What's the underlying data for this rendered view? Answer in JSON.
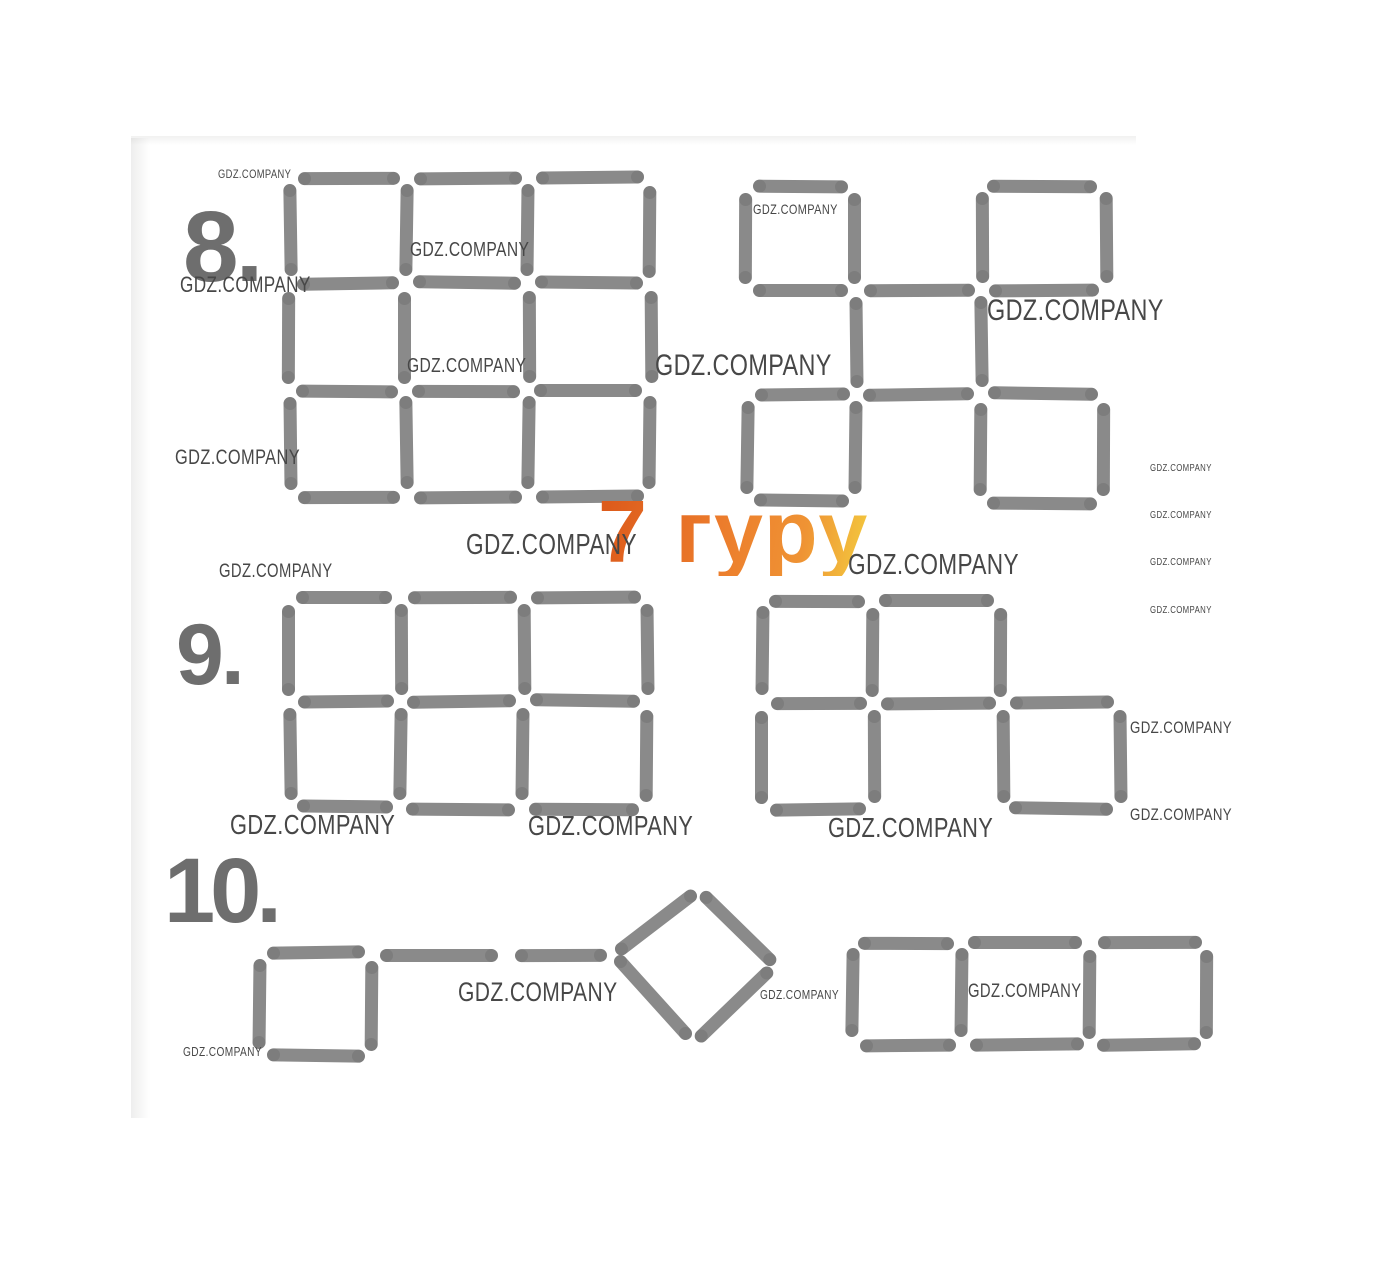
{
  "page": {
    "width": 1376,
    "height": 1261,
    "background": "#ffffff"
  },
  "colors": {
    "stick": "#8a8a8a",
    "stick_cap": "#6f6f6f",
    "label": "#6e6e6e",
    "watermark": "#474747",
    "logo_orange": [
      "#dd5c1c",
      "#ec7c2c",
      "#f3c83e"
    ]
  },
  "puzzles": [
    {
      "number": "8."
    },
    {
      "number": "9."
    },
    {
      "number": "10."
    }
  ],
  "logo": {
    "text": "7 гуру"
  },
  "watermark_text": "GDZ.COMPANY",
  "watermarks": [
    {
      "x": 218,
      "y": 171,
      "s": 12
    },
    {
      "x": 180,
      "y": 279,
      "s": 22
    },
    {
      "x": 410,
      "y": 244,
      "s": 20
    },
    {
      "x": 407,
      "y": 360,
      "s": 20
    },
    {
      "x": 175,
      "y": 452,
      "s": 21
    },
    {
      "x": 655,
      "y": 358,
      "s": 30
    },
    {
      "x": 753,
      "y": 205,
      "s": 14
    },
    {
      "x": 987,
      "y": 303,
      "s": 30
    },
    {
      "x": 1150,
      "y": 466,
      "s": 10
    },
    {
      "x": 1150,
      "y": 513,
      "s": 10
    },
    {
      "x": 1150,
      "y": 560,
      "s": 10
    },
    {
      "x": 1150,
      "y": 608,
      "s": 10
    },
    {
      "x": 466,
      "y": 537,
      "s": 29
    },
    {
      "x": 848,
      "y": 557,
      "s": 29
    },
    {
      "x": 219,
      "y": 566,
      "s": 19
    },
    {
      "x": 230,
      "y": 817,
      "s": 28
    },
    {
      "x": 528,
      "y": 818,
      "s": 28
    },
    {
      "x": 828,
      "y": 820,
      "s": 28
    },
    {
      "x": 1130,
      "y": 723,
      "s": 17
    },
    {
      "x": 1130,
      "y": 810,
      "s": 17
    },
    {
      "x": 458,
      "y": 985,
      "s": 27
    },
    {
      "x": 760,
      "y": 991,
      "s": 13
    },
    {
      "x": 968,
      "y": 986,
      "s": 19
    },
    {
      "x": 183,
      "y": 1048,
      "s": 13
    }
  ],
  "figures": {
    "grids": [
      {
        "name": "puzzle8-left-grid",
        "xs": [
          290,
          406,
          528,
          650
        ],
        "ys": [
          178,
          284,
          390,
          497
        ],
        "h": [
          [
            1,
            1,
            1
          ],
          [
            1,
            1,
            1
          ],
          [
            1,
            1,
            1
          ],
          [
            1,
            1,
            1
          ]
        ],
        "v": [
          [
            1,
            1,
            1,
            1
          ],
          [
            1,
            1,
            1,
            1
          ],
          [
            1,
            1,
            1,
            1
          ]
        ]
      },
      {
        "name": "puzzle8-right-grid",
        "xs": [
          747,
          856,
          981,
          1105
        ],
        "ys": [
          185,
          290,
          395,
          502
        ],
        "h": [
          [
            1,
            0,
            1
          ],
          [
            1,
            1,
            1
          ],
          [
            1,
            1,
            1
          ],
          [
            1,
            0,
            1
          ]
        ],
        "v": [
          [
            1,
            1,
            1,
            1
          ],
          [
            0,
            1,
            1,
            0
          ],
          [
            1,
            1,
            1,
            1
          ]
        ]
      },
      {
        "name": "puzzle9-left-grid",
        "xs": [
          290,
          400,
          523,
          647
        ],
        "ys": [
          597,
          702,
          808
        ],
        "h": [
          [
            1,
            1,
            1
          ],
          [
            1,
            1,
            1
          ],
          [
            1,
            1,
            1
          ]
        ],
        "v": [
          [
            1,
            1,
            1,
            1
          ],
          [
            1,
            1,
            1,
            1
          ]
        ]
      },
      {
        "name": "puzzle9-right-grid",
        "xs": [
          763,
          873,
          1002,
          1120
        ],
        "ys": [
          600,
          703,
          810
        ],
        "h": [
          [
            1,
            1,
            0
          ],
          [
            1,
            1,
            1
          ],
          [
            1,
            0,
            1
          ]
        ],
        "v": [
          [
            1,
            1,
            1,
            0
          ],
          [
            1,
            1,
            1,
            1
          ]
        ]
      },
      {
        "name": "puzzle10-square",
        "xs": [
          260,
          372
        ],
        "ys": [
          953,
          1057
        ],
        "h": [
          [
            1
          ],
          [
            1
          ]
        ],
        "v": [
          [
            1,
            1
          ]
        ]
      },
      {
        "name": "puzzle10-row-of-squares",
        "xs": [
          852,
          962,
          1090,
          1208
        ],
        "ys": [
          942,
          1045
        ],
        "h": [
          [
            1,
            1,
            1
          ],
          [
            1,
            1,
            1
          ]
        ],
        "v": [
          [
            1,
            1,
            1,
            1
          ]
        ]
      }
    ],
    "free_sticks": [
      {
        "figure": "puzzle10-shaft",
        "cx": 440,
        "cy": 955,
        "len": 118,
        "deg": 0
      },
      {
        "figure": "puzzle10-shaft",
        "cx": 560,
        "cy": 955,
        "len": 92,
        "deg": 0
      },
      {
        "figure": "puzzle10-diamond",
        "cx": 655,
        "cy": 922,
        "len": 100,
        "deg": -37
      },
      {
        "figure": "puzzle10-diamond",
        "cx": 737,
        "cy": 929,
        "len": 102,
        "deg": 45
      },
      {
        "figure": "puzzle10-diamond",
        "cx": 734,
        "cy": 1005,
        "len": 104,
        "deg": -43
      },
      {
        "figure": "puzzle10-diamond",
        "cx": 653,
        "cy": 999,
        "len": 110,
        "deg": 47
      }
    ]
  }
}
